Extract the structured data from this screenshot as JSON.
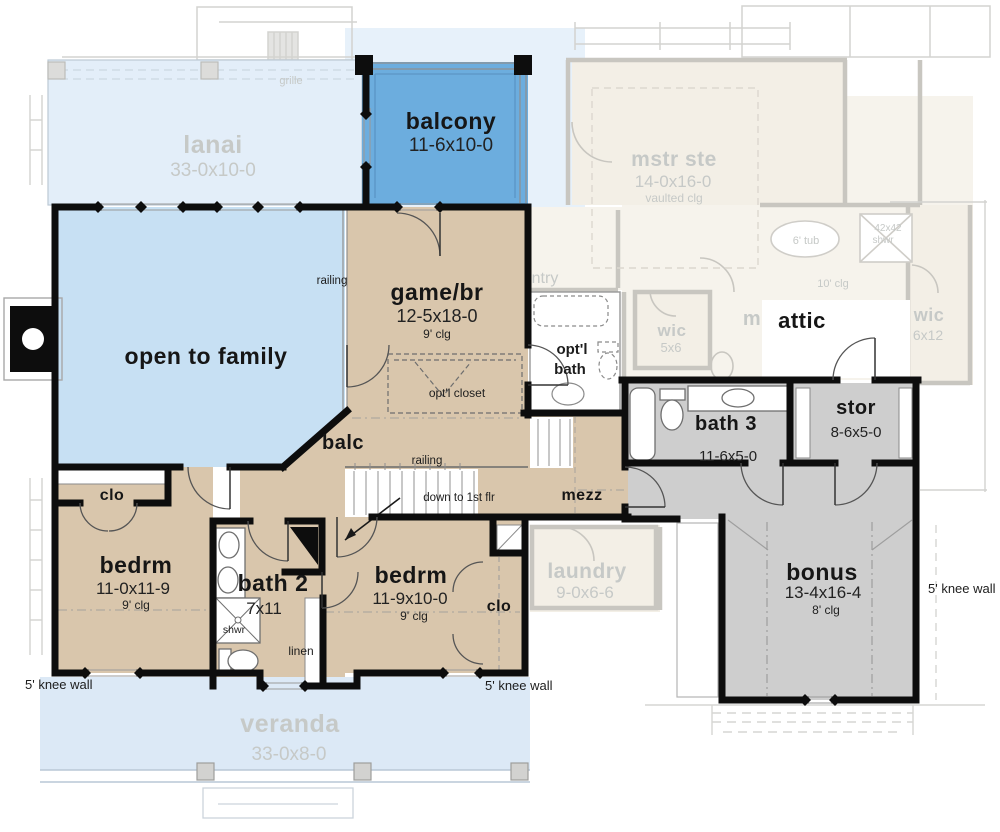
{
  "rooms": {
    "lanai": {
      "name": "lanai",
      "dims": "33-0x10-0"
    },
    "balcony": {
      "name": "balcony",
      "dims": "11-6x10-0"
    },
    "open_to_family": {
      "name": "open to family"
    },
    "game_br": {
      "name": "game/br",
      "dims": "12-5x18-0",
      "ceiling": "9' clg"
    },
    "optl_bath": {
      "line1": "opt'l",
      "line2": "bath"
    },
    "attic": {
      "name": "attic"
    },
    "bath3": {
      "name": "bath 3",
      "dims": "11-6x5-0"
    },
    "stor": {
      "name": "stor",
      "dims": "8-6x5-0"
    },
    "mezz": {
      "name": "mezz"
    },
    "balc": {
      "name": "balc"
    },
    "bedrm1": {
      "name": "bedrm",
      "dims": "11-0x11-9",
      "ceiling": "9' clg"
    },
    "bath2": {
      "name": "bath 2",
      "dims": "7x11",
      "shower": "shwr"
    },
    "bedrm2": {
      "name": "bedrm",
      "dims": "11-9x10-0",
      "ceiling": "9' clg"
    },
    "bonus": {
      "name": "bonus",
      "dims": "13-4x16-4",
      "ceiling": "8' clg"
    },
    "clo": {
      "name": "clo"
    },
    "linen": {
      "name": "linen"
    },
    "veranda": {
      "name": "veranda",
      "dims": "33-0x8-0"
    },
    "laundry": {
      "name": "laundry",
      "dims": "9-0x6-6"
    },
    "mstr_ste": {
      "name": "mstr ste",
      "dims": "14-0x16-0",
      "ceiling": "vaulted clg"
    },
    "wic_small": {
      "name": "wic",
      "dims": "5x6"
    },
    "wic_large": {
      "name": "wic",
      "dims": "6x12"
    },
    "pantry_partial": {
      "name": "ntry"
    },
    "mstr_partial": {
      "name": "m"
    }
  },
  "annotations": {
    "railing": "railing",
    "down_to_first": "down to 1st flr",
    "knee_wall": "5' knee wall",
    "grille": "grille",
    "optl_closet": "opt'l closet",
    "tub6": "6' tub",
    "shower_size": "42x42",
    "shower": "shwr",
    "clg10": "10' clg"
  },
  "colors": {
    "balcony_blue": "#6cadde",
    "family_blue": "#c7e0f3",
    "porch_blue": "#e3eef9",
    "veranda_blue": "#dce9f6",
    "floor_tan": "#d9c6ac",
    "room_gray": "#cecece",
    "ghost_line": "#c8c6c0",
    "ghost_fill": "#f3efe6",
    "wall_black": "#0d0d0d"
  }
}
